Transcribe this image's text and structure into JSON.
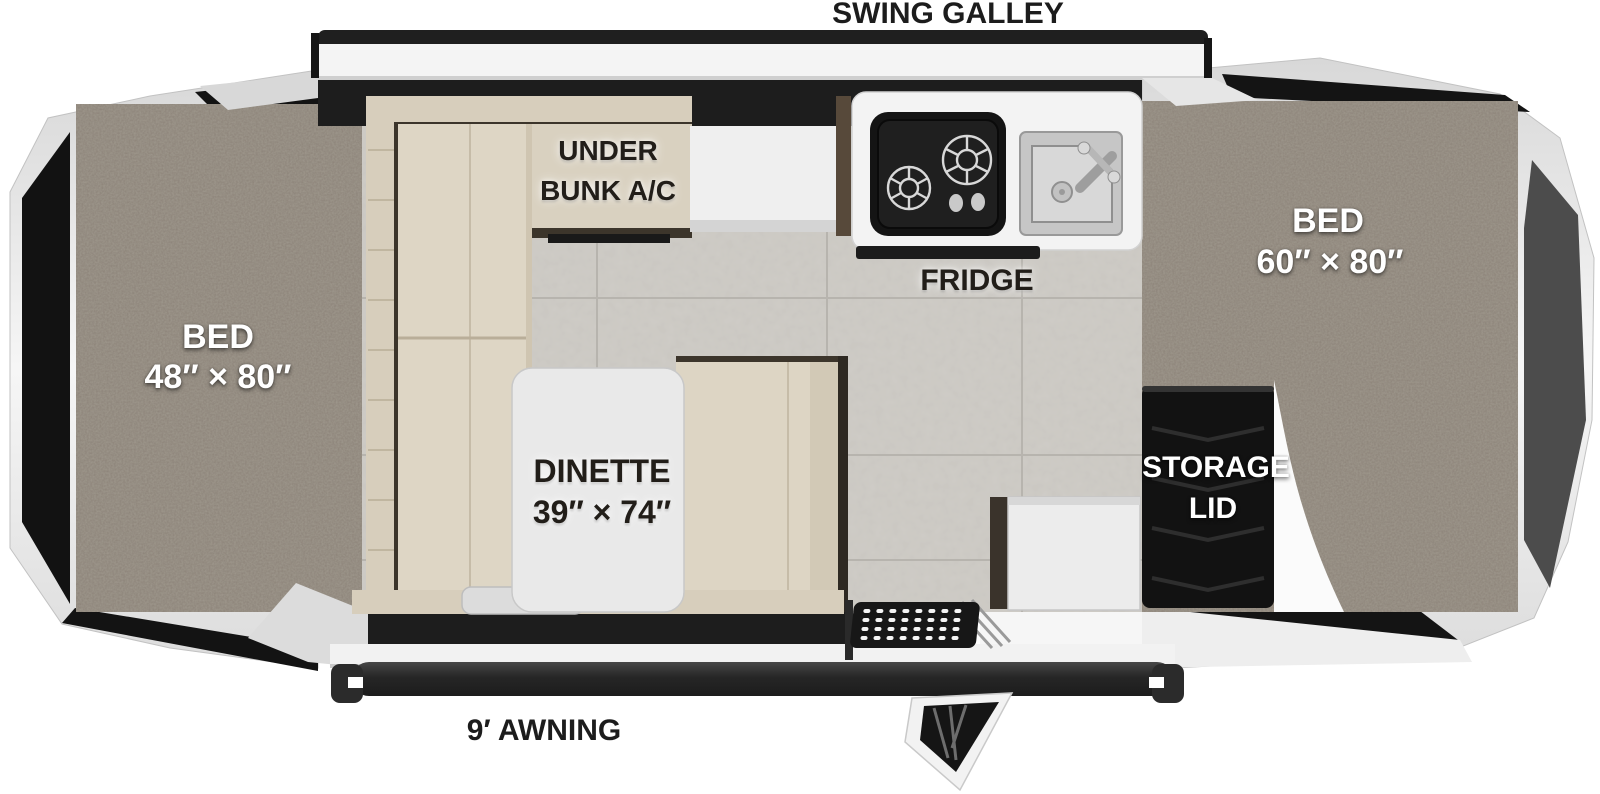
{
  "labels": {
    "swing_galley": "SWING GALLEY",
    "awning": "9′ AWNING",
    "bed_left_title": "BED",
    "bed_left_size": "48″ × 80″",
    "bed_right_title": "BED",
    "bed_right_size": "60″ × 80″",
    "under_bunk_line1": "UNDER",
    "under_bunk_line2": "BUNK A/C",
    "fridge": "FRIDGE",
    "dinette_title": "DINETTE",
    "dinette_size": "39″ × 74″",
    "storage_line1": "STORAGE",
    "storage_line2": "LID"
  },
  "colors": {
    "carpet": "#8b8277",
    "cushion": "#ddd5c3",
    "cushion_back": "#d7cebc",
    "trim_dark": "#3c352b",
    "tile_floor": "#cac7c1",
    "panel_black": "#181818",
    "panel_gray": "#4c4c4c",
    "shell_silver": "#e9e9e9",
    "counter_white": "#f3f3f3",
    "stove_black": "#1a1a1a",
    "awning_bar": "#2d2d2d"
  }
}
